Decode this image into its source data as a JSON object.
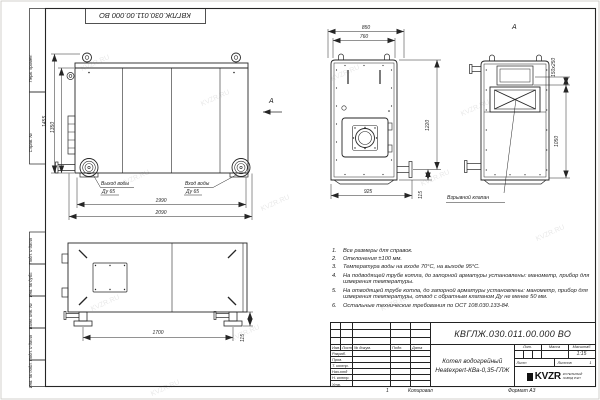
{
  "watermark": "KVZR.RU",
  "frame": {
    "doc_number_top": "КВГЛЖ.030.011.00.000 ВО",
    "margin_labels": [
      "Перв. примен.",
      "Справ. №",
      "Подп. и дата",
      "Инв. № дубл.",
      "Взам. инв. №",
      "Подп. и дата",
      "Инв. № подл."
    ]
  },
  "side_view": {
    "dim_height_outer": "1455",
    "dim_height_inner": "1350",
    "dim_width_inner": "1990",
    "dim_width_outer": "2090",
    "outlet_line1": "Выход воды",
    "outlet_line2": "Ду 65",
    "inlet_line1": "Вход воды",
    "inlet_line2": "Ду 65",
    "view_arrow": "А"
  },
  "front_view": {
    "dim_top_outer": "850",
    "dim_top_inner": "760",
    "dim_height": "1220",
    "dim_flange": "115",
    "dim_bottom": "925"
  },
  "rear_view": {
    "title": "А",
    "dim_chimney": "150х250",
    "dim_height": "1050",
    "valve_label": "Взрывной клапан"
  },
  "top_view": {
    "dim_feet": "1700",
    "dim_foot_offset": "115"
  },
  "notes": [
    {
      "n": "1.",
      "text": "Все размеры для справок."
    },
    {
      "n": "2.",
      "text": "Отклонения ±100 мм."
    },
    {
      "n": "3.",
      "text": "Температура воды на входе 70°С, на выходе 95°С."
    },
    {
      "n": "4.",
      "text": "На подводящей трубе котла, до запорной арматуры установлены: манометр, прибор для измерения температуры."
    },
    {
      "n": "5.",
      "text": "На отводящей трубе котла, до запорной арматуры установлены: манометр, прибор для измерения температуры, отвод с обратным клапаном Ду не менее 50 мм."
    },
    {
      "n": "6.",
      "text": "Остальные технические требования по ОСТ 108.030.133-84."
    }
  ],
  "title_block": {
    "doc_number": "КВГЛЖ.030.011.00.000 ВО",
    "header_cols": [
      "Изм.",
      "Лист",
      "№ докум.",
      "Подп.",
      "Дата"
    ],
    "sig_rows": [
      "Разраб.",
      "Пров.",
      "Т. контр.",
      "Нач.отд",
      "Н. контр.",
      "Утв."
    ],
    "product_line1": "Котел водогрейный",
    "product_line2": "Heatexpert-КВа-0,35-ГЛЖ",
    "lit_label": "Лит.",
    "mass_label": "Масса",
    "scale_label": "Масштаб",
    "scale_value": "1:15",
    "sheet_label": "Лист",
    "sheets_label": "Листов",
    "sheets_value": "1",
    "logo_text": "KVZR",
    "logo_sub1": "КОТЕЛЬНЫЙ",
    "logo_sub2": "ЗАВОД РЭП"
  },
  "footer": {
    "mark": "1",
    "copied_label": "Копировал",
    "format_label": "Формат А3"
  }
}
